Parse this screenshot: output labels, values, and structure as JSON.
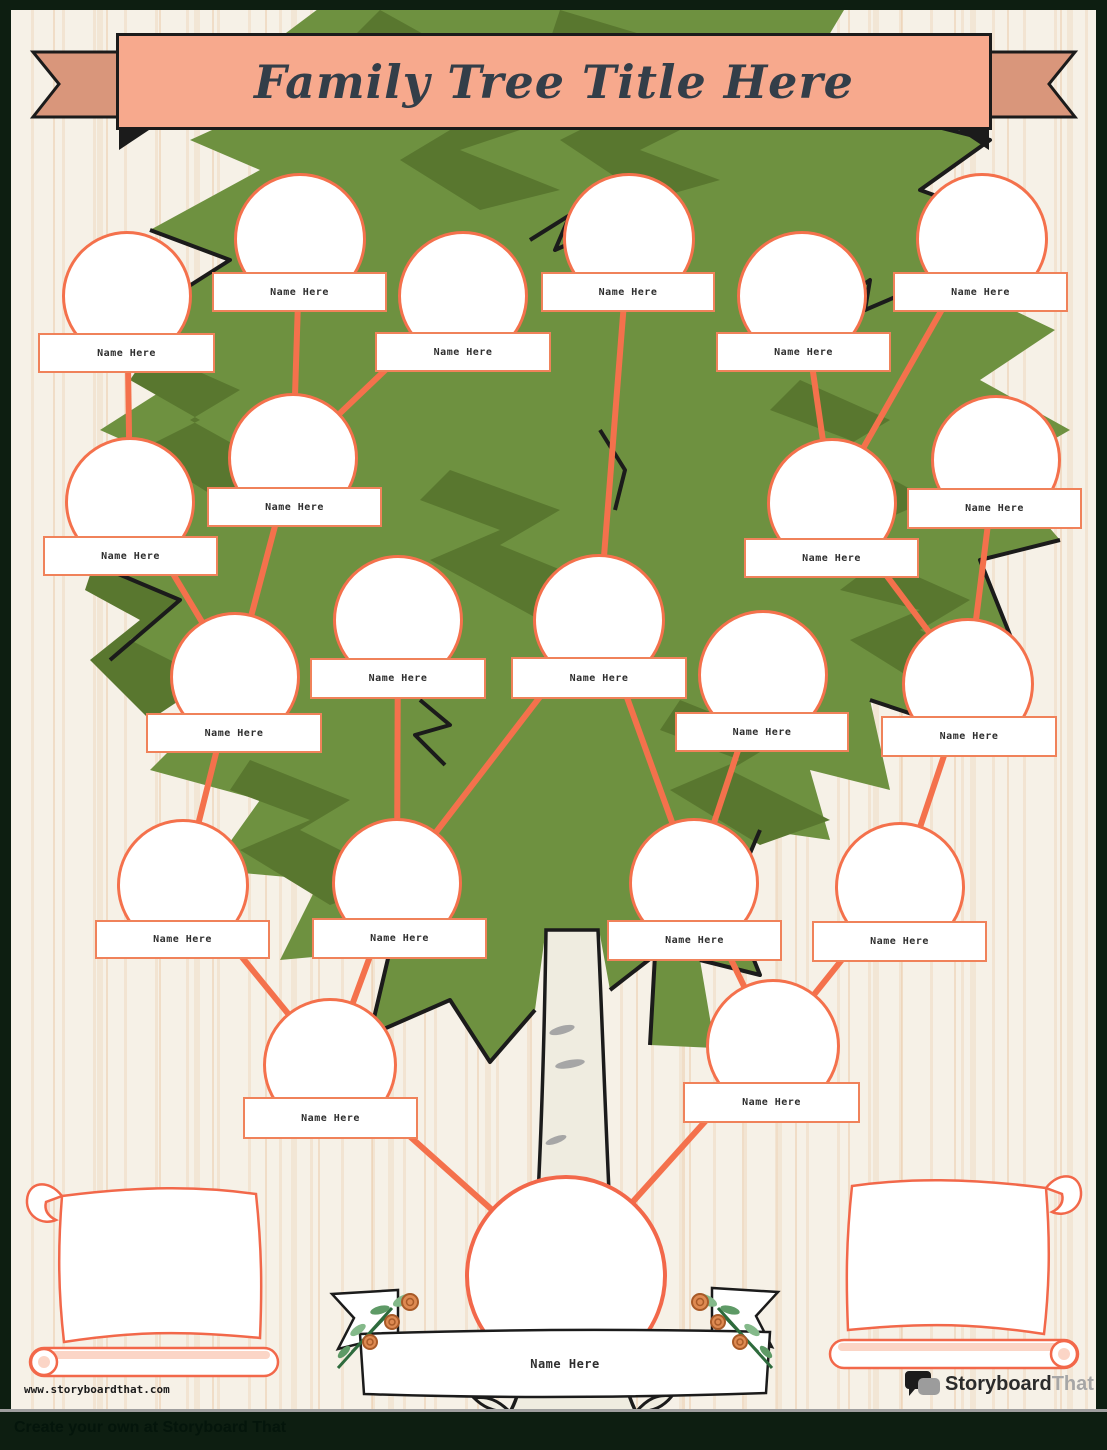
{
  "page": {
    "title": "Family Tree Title Here",
    "footer_url": "www.storyboardthat.com",
    "watermark": "Create your own at Storyboard That",
    "logo_primary": "Storyboard",
    "logo_secondary": "That"
  },
  "colors": {
    "accent_orange": "#F4714C",
    "label_border_orange": "#F0825A",
    "banner_fill": "#F7A98D",
    "banner_tail": "#D9967B",
    "banner_text": "#333E49",
    "canopy_green": "#6E9140",
    "canopy_dark_green": "#59772F",
    "trunk_cream": "#EFECE0",
    "background_cream": "#F6F1E7",
    "footer_bar_dark": "#0D1E11",
    "scroll_outline": "#F2684A",
    "scroll_shade_pink": "#FBD5C6"
  },
  "tree": {
    "default_name": "Name Here",
    "nodes": [
      {
        "id": 1,
        "label": "Name Here",
        "x": 127,
        "y": 296,
        "r": 65,
        "box": [
          38,
          333,
          177,
          40
        ]
      },
      {
        "id": 2,
        "label": "Name Here",
        "x": 300,
        "y": 239,
        "r": 66,
        "box": [
          212,
          272,
          175,
          40
        ]
      },
      {
        "id": 3,
        "label": "Name Here",
        "x": 463,
        "y": 296,
        "r": 65,
        "box": [
          375,
          332,
          176,
          40
        ]
      },
      {
        "id": 4,
        "label": "Name Here",
        "x": 629,
        "y": 239,
        "r": 66,
        "box": [
          541,
          272,
          174,
          40
        ]
      },
      {
        "id": 5,
        "label": "Name Here",
        "x": 802,
        "y": 296,
        "r": 65,
        "box": [
          716,
          332,
          175,
          40
        ]
      },
      {
        "id": 6,
        "label": "Name Here",
        "x": 982,
        "y": 239,
        "r": 66,
        "box": [
          893,
          272,
          175,
          40
        ]
      },
      {
        "id": 7,
        "label": "Name Here",
        "x": 130,
        "y": 502,
        "r": 65,
        "box": [
          43,
          536,
          175,
          40
        ]
      },
      {
        "id": 8,
        "label": "Name Here",
        "x": 293,
        "y": 458,
        "r": 65,
        "box": [
          207,
          487,
          175,
          40
        ]
      },
      {
        "id": 9,
        "label": "Name Here",
        "x": 832,
        "y": 503,
        "r": 65,
        "box": [
          744,
          538,
          175,
          40
        ]
      },
      {
        "id": 10,
        "label": "Name Here",
        "x": 996,
        "y": 460,
        "r": 65,
        "box": [
          907,
          488,
          175,
          41
        ]
      },
      {
        "id": 11,
        "label": "Name Here",
        "x": 235,
        "y": 677,
        "r": 65,
        "box": [
          146,
          713,
          176,
          40
        ]
      },
      {
        "id": 12,
        "label": "Name Here",
        "x": 398,
        "y": 620,
        "r": 65,
        "box": [
          310,
          658,
          176,
          41
        ]
      },
      {
        "id": 13,
        "label": "Name Here",
        "x": 599,
        "y": 620,
        "r": 66,
        "box": [
          511,
          657,
          176,
          42
        ]
      },
      {
        "id": 14,
        "label": "Name Here",
        "x": 763,
        "y": 675,
        "r": 65,
        "box": [
          675,
          712,
          174,
          40
        ]
      },
      {
        "id": 15,
        "label": "Name Here",
        "x": 968,
        "y": 684,
        "r": 66,
        "box": [
          881,
          716,
          176,
          41
        ]
      },
      {
        "id": 16,
        "label": "Name Here",
        "x": 183,
        "y": 885,
        "r": 66,
        "box": [
          95,
          920,
          175,
          39
        ]
      },
      {
        "id": 17,
        "label": "Name Here",
        "x": 397,
        "y": 883,
        "r": 65,
        "box": [
          312,
          918,
          175,
          41
        ]
      },
      {
        "id": 18,
        "label": "Name Here",
        "x": 694,
        "y": 883,
        "r": 65,
        "box": [
          607,
          920,
          175,
          41
        ]
      },
      {
        "id": 19,
        "label": "Name Here",
        "x": 900,
        "y": 887,
        "r": 65,
        "box": [
          812,
          921,
          175,
          41
        ]
      },
      {
        "id": 20,
        "label": "Name Here",
        "x": 330,
        "y": 1065,
        "r": 67,
        "box": [
          243,
          1097,
          175,
          42
        ]
      },
      {
        "id": 21,
        "label": "Name Here",
        "x": 773,
        "y": 1046,
        "r": 67,
        "box": [
          683,
          1082,
          177,
          41
        ]
      },
      {
        "id": 22,
        "label": "Name Here",
        "x": 566,
        "y": 1276,
        "r": 101,
        "box": null,
        "root": true
      }
    ],
    "connections": [
      [
        1,
        7
      ],
      [
        2,
        8
      ],
      [
        3,
        8
      ],
      [
        5,
        9
      ],
      [
        6,
        9
      ],
      [
        4,
        13
      ],
      [
        7,
        11
      ],
      [
        8,
        11
      ],
      [
        9,
        15
      ],
      [
        10,
        15
      ],
      [
        11,
        16
      ],
      [
        12,
        17
      ],
      [
        13,
        17
      ],
      [
        13,
        18
      ],
      [
        14,
        18
      ],
      [
        15,
        19
      ],
      [
        16,
        20
      ],
      [
        17,
        20
      ],
      [
        18,
        21
      ],
      [
        19,
        21
      ],
      [
        20,
        22
      ],
      [
        21,
        22
      ]
    ]
  }
}
